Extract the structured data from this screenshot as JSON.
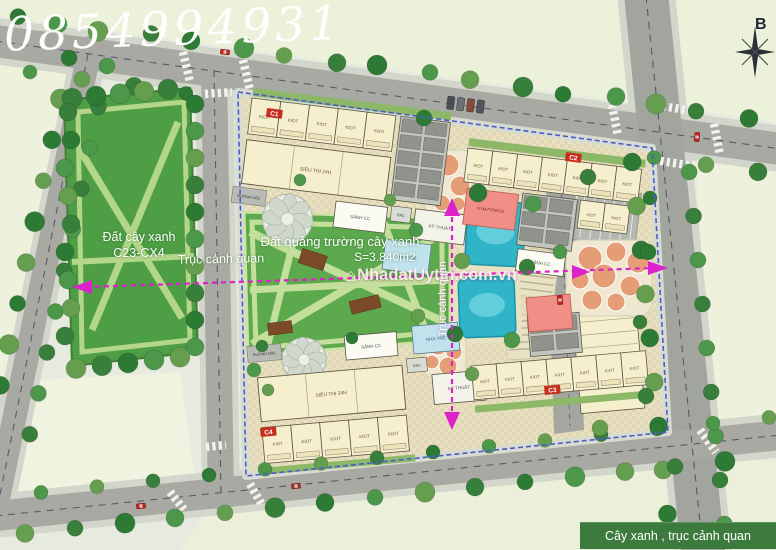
{
  "watermarks": {
    "phone": "0854994931",
    "site": "NhadatUytin.com.vn"
  },
  "compass": {
    "north_label": "B"
  },
  "park": {
    "name": "Đất cây xanh",
    "code": "C23-CX4"
  },
  "plaza": {
    "name": "Đất quảng trường cây xanh",
    "area": "S=3.840m2"
  },
  "axes": {
    "horizontal_label": "Trục cảnh quan",
    "vertical_label": "Trục cảnh quan"
  },
  "legend": {
    "text": "Cây xanh , trục cảnh quan"
  },
  "blocks": {
    "c1": {
      "label": "C1",
      "units": [
        "KIOT",
        "KIOT",
        "KIOT",
        "KIOT",
        "KIOT"
      ]
    },
    "c2": {
      "label": "C2",
      "units": [
        "KIOT",
        "KIOT",
        "KIOT",
        "KIOT",
        "KIOT",
        "KIOT",
        "KIOT"
      ],
      "units2": [
        "KIOT",
        "KIOT"
      ]
    },
    "c3": {
      "label": "C3",
      "units": [
        "KIOT",
        "KIOT",
        "KIOT",
        "KIOT",
        "KIOT",
        "KIOT",
        "KIOT"
      ]
    },
    "c4": {
      "label": "C4",
      "units": [
        "KIOT",
        "KIOT",
        "KIOT",
        "KIOT",
        "KIOT"
      ]
    }
  },
  "rooms": {
    "supermarket": "SIÊU THỊ 24H",
    "lobby": "SẢNH CC",
    "kindergarten": "NHÀ TRẺ",
    "technical": "KỸ THUẬT",
    "gym": "GYM-FITNESS",
    "trash": "RÁC",
    "ramp": "ĐƯỜNG DỐC"
  },
  "colors": {
    "axis": "#dd22cc",
    "boundary": "#4a5bd0",
    "pool": "#2fb4c8",
    "park_green": "#4e9e45",
    "plaza_green": "#5ca94e",
    "building": "#f6efcd",
    "accent_red": "#c62f1f",
    "legend_bg": "#3c7a3e"
  }
}
